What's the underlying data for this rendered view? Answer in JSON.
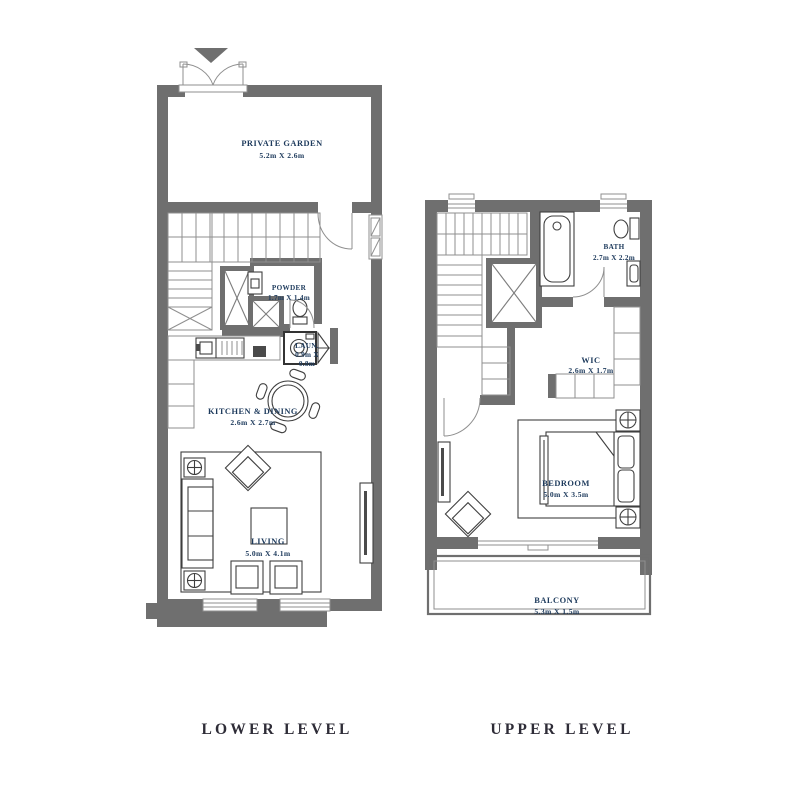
{
  "colors": {
    "background": "#ffffff",
    "wall_gray": "#6f6f6f",
    "thin_line_gray": "#8f8f8f",
    "furniture_line": "#3f3f3f",
    "room_label_blue": "#1d3a5c",
    "footer_text": "#2e2c37"
  },
  "lower": {
    "footer": "LOWER LEVEL",
    "garden": {
      "name": "PRIVATE GARDEN",
      "dims": "5.2m X 2.6m"
    },
    "powder": {
      "name": "POWDER",
      "dims": "1.7m X 1.4m"
    },
    "laundry": {
      "name": "LAUN.",
      "dims1": "0.9m X",
      "dims2": "0.8m"
    },
    "kitchen": {
      "name": "KITCHEN & DINING",
      "dims": "2.6m X 2.7m"
    },
    "living": {
      "name": "LIVING",
      "dims": "5.0m X 4.1m"
    }
  },
  "upper": {
    "footer": "UPPER LEVEL",
    "bath": {
      "name": "BATH",
      "dims": "2.7m X 2.2m"
    },
    "wic": {
      "name": "WIC",
      "dims": "2.6m X 1.7m"
    },
    "bedroom": {
      "name": "BEDROOM",
      "dims": "5.0m X 3.5m"
    },
    "balcony": {
      "name": "BALCONY",
      "dims": "5.3m X 1.5m"
    }
  }
}
